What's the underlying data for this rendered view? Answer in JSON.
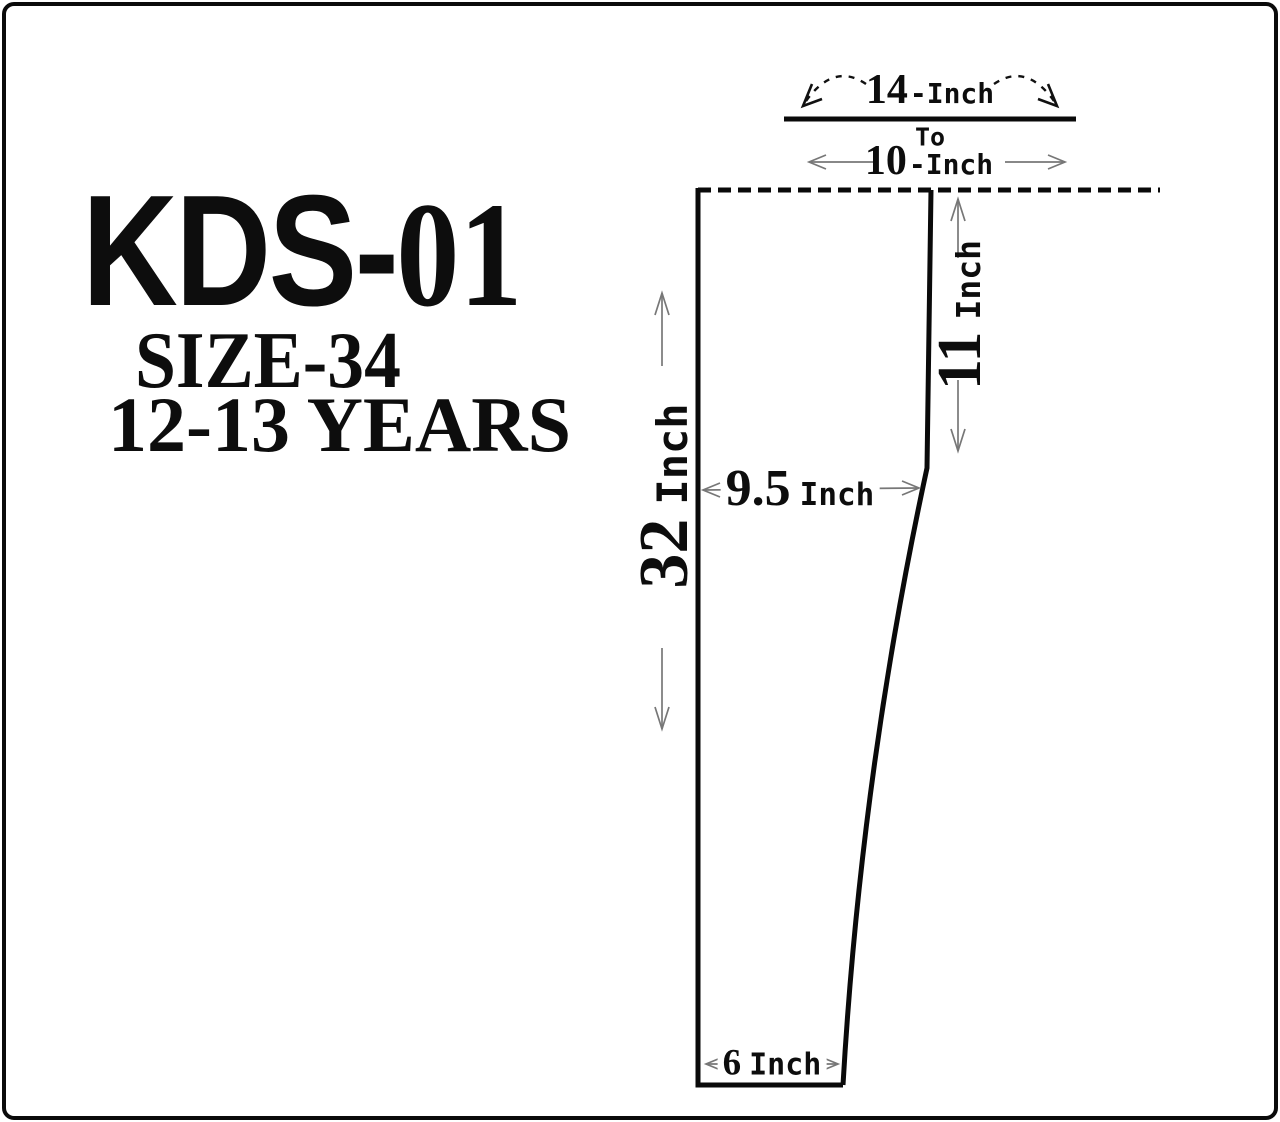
{
  "header": {
    "model": {
      "part1": "KDS-",
      "part2": "01"
    },
    "size": "SIZE-34",
    "age_range": "12-13 YEARS"
  },
  "dimensions": {
    "waist_stretched": {
      "value": "14",
      "unit": "-Inch"
    },
    "range_connector": "To",
    "waist_relaxed": {
      "value": "10",
      "unit": "-Inch"
    },
    "rise": {
      "value": "11",
      "unit": "Inch"
    },
    "length": {
      "value": "32",
      "unit": "Inch"
    },
    "thigh": {
      "value": "9.5",
      "unit": "Inch"
    },
    "leg_opening": {
      "value": "6",
      "unit": "Inch"
    }
  },
  "colors": {
    "ink": "#0d0d0d",
    "dimension_lines": "#777777",
    "background": "#ffffff"
  }
}
